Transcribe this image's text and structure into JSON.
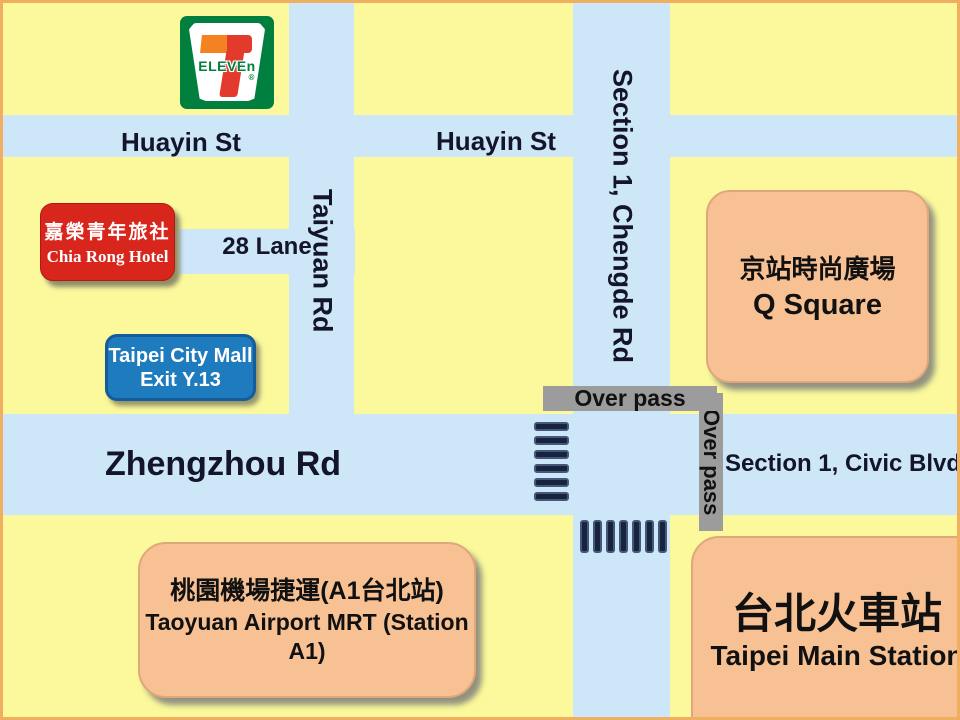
{
  "colors": {
    "background_yellow": "#FBF99B",
    "road_blue": "#CEE7F8",
    "frame_orange": "#F0AE61",
    "overpass_gray": "#9C9C9C",
    "crosswalk_navy": "#18233D",
    "hotel_red": "#D8261C",
    "mall_blue": "#1E7BBE",
    "landmark_orange": "#F7C194",
    "seven_green": "#007F3F",
    "seven_orange": "#F58220",
    "seven_red": "#E23A2C"
  },
  "roads": {
    "huayin_left_label": "Huayin St",
    "huayin_right_label": "Huayin St",
    "taiyuan_label": "Taiyuan Rd",
    "chengde_label": "Section 1, Chengde Rd",
    "lane28_label": "28 Lane",
    "zhengzhou_label": "Zhengzhou Rd",
    "civic_label": "Section 1, Civic Blvd"
  },
  "overpass": {
    "horizontal_label": "Over pass",
    "vertical_label": "Over pass"
  },
  "crosswalks": {
    "west_bar_count": 6,
    "south_bar_count": 7
  },
  "landmarks": {
    "seven_eleven": {
      "digit": "7",
      "word": "ELEVEn",
      "registered": "®"
    },
    "hotel": {
      "line_zh": "嘉榮青年旅社",
      "line_en": "Chia Rong Hotel"
    },
    "city_mall": {
      "line1": "Taipei City Mall",
      "line2": "Exit Y.13"
    },
    "q_square": {
      "line_zh": "京站時尚廣場",
      "line_en": "Q Square"
    },
    "airport_mrt": {
      "line_zh": "桃園機場捷運(A1台北站)",
      "line_en": "Taoyuan Airport MRT (Station A1)"
    },
    "main_station": {
      "line_zh": "台北火車站",
      "line_en": "Taipei Main Station"
    }
  }
}
